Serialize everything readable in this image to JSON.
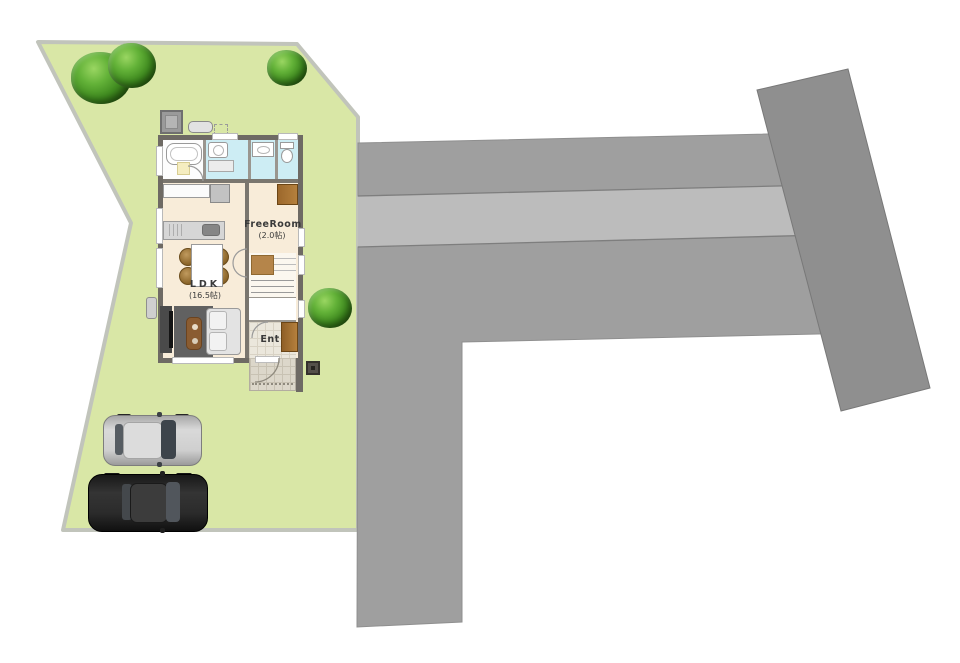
{
  "site": {
    "colors": {
      "lawn": "#d9e7a6",
      "lot_border": "#c1c4bb",
      "road_dark": "#9f9f9f",
      "road_light_band": "#bcbcbc",
      "diagonal_block": "#8f8f8f"
    },
    "tree_count": 4
  },
  "floor_plan": {
    "rooms": {
      "ldk": {
        "label": "LDK",
        "area": "(16.5帖)"
      },
      "free_room": {
        "label": "FreeRoom",
        "area": "(2.0帖)"
      },
      "entrance": {
        "label": "Ent"
      }
    }
  },
  "vehicles": [
    {
      "name": "silver car",
      "body_color": "#c9c9c9"
    },
    {
      "name": "black car",
      "body_color": "#232323"
    }
  ]
}
